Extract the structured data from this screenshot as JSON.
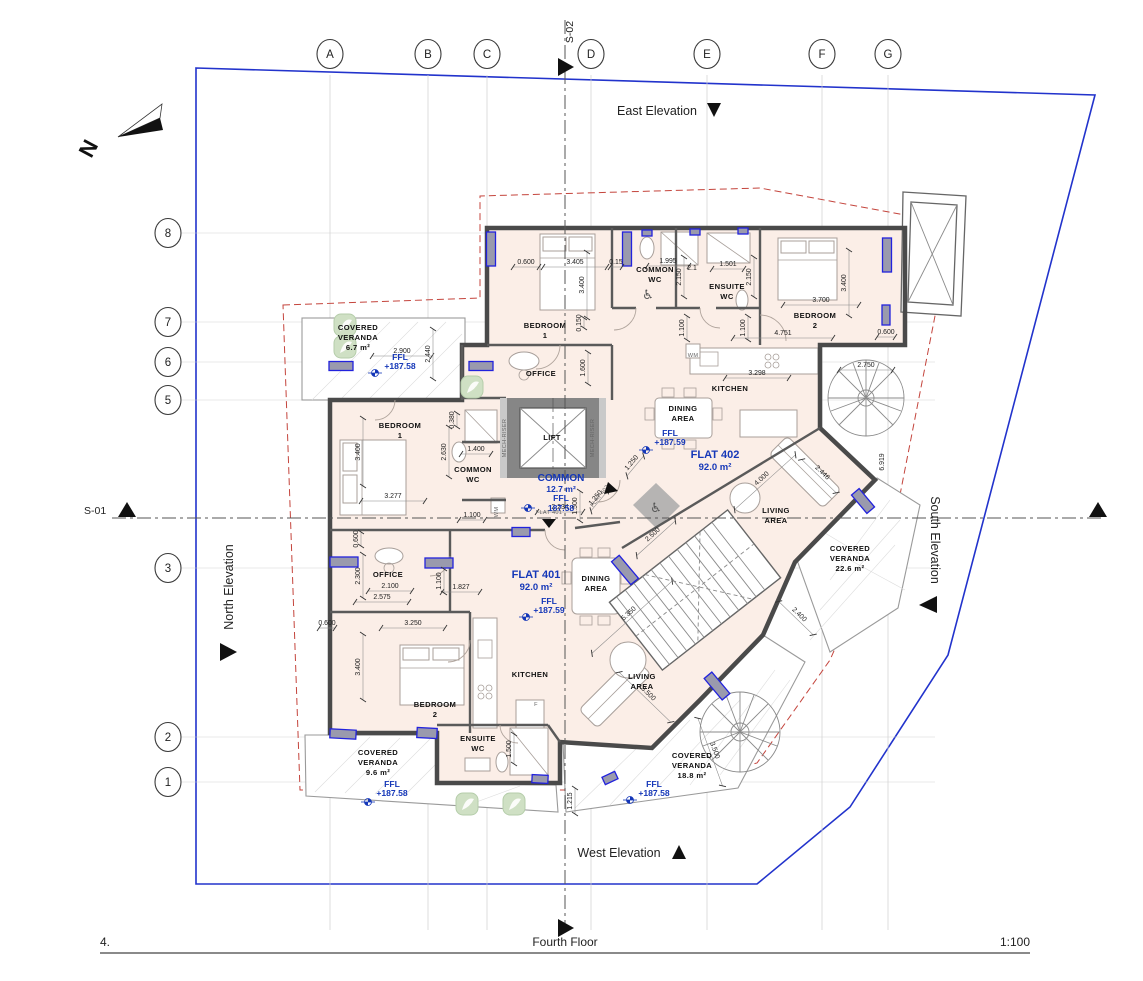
{
  "sheet": {
    "number": "4.",
    "title": "Fourth Floor",
    "scale": "1:100"
  },
  "north_arrow": {
    "label": "N"
  },
  "section_markers": {
    "s01": "S-01",
    "s02": "S-02"
  },
  "elevation_labels": {
    "east": "East Elevation",
    "west": "West Elevation",
    "north": "North Elevation",
    "south": "South Elevation"
  },
  "grid": {
    "columns": [
      {
        "label": "A",
        "x": 330
      },
      {
        "label": "B",
        "x": 428
      },
      {
        "label": "C",
        "x": 487
      },
      {
        "label": "D",
        "x": 591
      },
      {
        "label": "E",
        "x": 707
      },
      {
        "label": "F",
        "x": 822
      },
      {
        "label": "G",
        "x": 888
      }
    ],
    "rows": [
      {
        "label": "8",
        "y": 233
      },
      {
        "label": "7",
        "y": 322
      },
      {
        "label": "6",
        "y": 362
      },
      {
        "label": "5",
        "y": 400
      },
      {
        "label": "3",
        "y": 568
      },
      {
        "label": "2",
        "y": 737
      },
      {
        "label": "1",
        "y": 782
      }
    ]
  },
  "flats": [
    {
      "id": "FLAT 401",
      "area": "92.0 m²",
      "ffl": "+187.59"
    },
    {
      "id": "FLAT 402",
      "area": "92.0 m²",
      "ffl": "+187.59"
    }
  ],
  "common_area": {
    "name": "COMMON",
    "area": "12.7 m²",
    "ffl": "187.58"
  },
  "room_labels": [
    {
      "t": "BEDROOM",
      "x": 545,
      "y": 328
    },
    {
      "t": "1",
      "x": 545,
      "y": 338
    },
    {
      "t": "COMMON",
      "x": 655,
      "y": 272
    },
    {
      "t": "WC",
      "x": 655,
      "y": 282
    },
    {
      "t": "ENSUITE",
      "x": 727,
      "y": 289
    },
    {
      "t": "WC",
      "x": 727,
      "y": 299
    },
    {
      "t": "BEDROOM",
      "x": 815,
      "y": 318
    },
    {
      "t": "2",
      "x": 815,
      "y": 328
    },
    {
      "t": "OFFICE",
      "x": 541,
      "y": 376
    },
    {
      "t": "KITCHEN",
      "x": 730,
      "y": 391
    },
    {
      "t": "DINING",
      "x": 683,
      "y": 411
    },
    {
      "t": "AREA",
      "x": 683,
      "y": 421
    },
    {
      "t": "LIVING",
      "x": 776,
      "y": 513
    },
    {
      "t": "AREA",
      "x": 776,
      "y": 523
    },
    {
      "t": "BEDROOM",
      "x": 400,
      "y": 428
    },
    {
      "t": "1",
      "x": 400,
      "y": 438
    },
    {
      "t": "COMMON",
      "x": 473,
      "y": 472
    },
    {
      "t": "WC",
      "x": 473,
      "y": 482
    },
    {
      "t": "LIFT",
      "x": 552,
      "y": 440
    },
    {
      "t": "OFFICE",
      "x": 388,
      "y": 577
    },
    {
      "t": "DINING",
      "x": 596,
      "y": 581
    },
    {
      "t": "AREA",
      "x": 596,
      "y": 591
    },
    {
      "t": "KITCHEN",
      "x": 530,
      "y": 677
    },
    {
      "t": "LIVING",
      "x": 642,
      "y": 679
    },
    {
      "t": "AREA",
      "x": 642,
      "y": 689
    },
    {
      "t": "BEDROOM",
      "x": 435,
      "y": 707
    },
    {
      "t": "2",
      "x": 435,
      "y": 717
    },
    {
      "t": "ENSUITE",
      "x": 478,
      "y": 741
    },
    {
      "t": "WC",
      "x": 478,
      "y": 751
    }
  ],
  "veranda_labels": [
    {
      "t": "COVERED",
      "x": 358,
      "y": 330
    },
    {
      "t": "VERANDA",
      "x": 358,
      "y": 340
    },
    {
      "t": "6.7 m²",
      "x": 358,
      "y": 350
    },
    {
      "t": "COVERED",
      "x": 378,
      "y": 755
    },
    {
      "t": "VERANDA",
      "x": 378,
      "y": 765
    },
    {
      "t": "9.6 m²",
      "x": 378,
      "y": 775
    },
    {
      "t": "COVERED",
      "x": 692,
      "y": 758
    },
    {
      "t": "VERANDA",
      "x": 692,
      "y": 768
    },
    {
      "t": "18.8 m²",
      "x": 692,
      "y": 778
    },
    {
      "t": "COVERED",
      "x": 850,
      "y": 551
    },
    {
      "t": "VERANDA",
      "x": 850,
      "y": 561
    },
    {
      "t": "22.6 m²",
      "x": 850,
      "y": 571
    }
  ],
  "blue_labels": [
    {
      "t": "FFL",
      "x": 400,
      "y": 360
    },
    {
      "t": "+187.58",
      "x": 400,
      "y": 369
    },
    {
      "t": "COMMON",
      "x": 561,
      "y": 481,
      "s": 10
    },
    {
      "t": "12.7 m²",
      "x": 561,
      "y": 492
    },
    {
      "t": "FFL",
      "x": 561,
      "y": 501
    },
    {
      "t": "187.58",
      "x": 561,
      "y": 511
    },
    {
      "t": "FLAT 402",
      "x": 715,
      "y": 458,
      "s": 11
    },
    {
      "t": "92.0 m²",
      "x": 715,
      "y": 470,
      "s": 9.5
    },
    {
      "t": "FFL",
      "x": 670,
      "y": 436
    },
    {
      "t": "+187.59",
      "x": 670,
      "y": 445
    },
    {
      "t": "FLAT 401",
      "x": 536,
      "y": 578,
      "s": 11
    },
    {
      "t": "92.0 m²",
      "x": 536,
      "y": 590,
      "s": 9.5
    },
    {
      "t": "FFL",
      "x": 549,
      "y": 604
    },
    {
      "t": "+187.59",
      "x": 549,
      "y": 613
    },
    {
      "t": "FFL",
      "x": 392,
      "y": 787
    },
    {
      "t": "+187.58",
      "x": 392,
      "y": 796
    },
    {
      "t": "FFL",
      "x": 654,
      "y": 787
    },
    {
      "t": "+187.58",
      "x": 654,
      "y": 796
    }
  ],
  "dimensions": [
    {
      "t": "0.600",
      "x": 526,
      "y": 264,
      "l": 26
    },
    {
      "t": "3.405",
      "x": 575,
      "y": 264,
      "l": 64
    },
    {
      "t": "0.15",
      "x": 616,
      "y": 264,
      "l": 12
    },
    {
      "t": "1.995",
      "x": 668,
      "y": 263,
      "l": 42
    },
    {
      "t": "2.1",
      "x": 692,
      "y": 270
    },
    {
      "t": "1.501",
      "x": 728,
      "y": 266,
      "l": 32
    },
    {
      "t": "2.150",
      "x": 681,
      "y": 277,
      "r": -90,
      "l": 40
    },
    {
      "t": "2.150",
      "x": 751,
      "y": 277,
      "r": -90,
      "l": 40
    },
    {
      "t": "3.400",
      "x": 584,
      "y": 285,
      "r": -90,
      "l": 66
    },
    {
      "t": "0.150",
      "x": 581,
      "y": 323,
      "r": -90,
      "l": 10
    },
    {
      "t": "1.600",
      "x": 585,
      "y": 368,
      "r": -90,
      "l": 32
    },
    {
      "t": "1.100",
      "x": 684,
      "y": 328,
      "r": -90,
      "l": 24
    },
    {
      "t": "1.100",
      "x": 745,
      "y": 328,
      "r": -90,
      "l": 24
    },
    {
      "t": "3.700",
      "x": 821,
      "y": 302,
      "l": 76
    },
    {
      "t": "3.400",
      "x": 846,
      "y": 283,
      "r": -90,
      "l": 66
    },
    {
      "t": "4.751",
      "x": 783,
      "y": 335,
      "l": 100
    },
    {
      "t": "0.600",
      "x": 886,
      "y": 334,
      "l": 18
    },
    {
      "t": "2.750",
      "x": 866,
      "y": 367,
      "l": 54
    },
    {
      "t": "3.298",
      "x": 757,
      "y": 375,
      "l": 64
    },
    {
      "t": "2.900",
      "x": 402,
      "y": 353,
      "l": 60
    },
    {
      "t": "2.440",
      "x": 430,
      "y": 354,
      "r": -90,
      "l": 50
    },
    {
      "t": "3.400",
      "x": 360,
      "y": 452,
      "r": -90,
      "l": 68
    },
    {
      "t": "3.277",
      "x": 393,
      "y": 498,
      "l": 64
    },
    {
      "t": "1.400",
      "x": 476,
      "y": 451,
      "l": 30
    },
    {
      "t": "0.380",
      "x": 454,
      "y": 420,
      "r": -90,
      "l": 14
    },
    {
      "t": "2.630",
      "x": 446,
      "y": 452,
      "r": -90,
      "l": 50
    },
    {
      "t": "1.100",
      "x": 472,
      "y": 517,
      "l": 26
    },
    {
      "t": "2.234",
      "x": 560,
      "y": 509,
      "l": 46
    },
    {
      "t": "1.500",
      "x": 577,
      "y": 506,
      "r": -90,
      "l": 30
    },
    {
      "t": "1.250",
      "x": 633,
      "y": 464,
      "r": -50,
      "l": 26
    },
    {
      "t": "1.250",
      "x": 597,
      "y": 499,
      "r": -50,
      "l": 26
    },
    {
      "t": "2.300",
      "x": 360,
      "y": 576,
      "r": -90,
      "l": 44
    },
    {
      "t": "0.600",
      "x": 358,
      "y": 539,
      "r": -90,
      "l": 14
    },
    {
      "t": "2.100",
      "x": 390,
      "y": 588,
      "l": 44
    },
    {
      "t": "2.575",
      "x": 382,
      "y": 599,
      "l": 54
    },
    {
      "t": "1.827",
      "x": 461,
      "y": 589,
      "l": 38
    },
    {
      "t": "1.100",
      "x": 441,
      "y": 581,
      "r": -90,
      "l": 24
    },
    {
      "t": "0.600",
      "x": 327,
      "y": 625,
      "l": 16
    },
    {
      "t": "3.250",
      "x": 413,
      "y": 625,
      "l": 64
    },
    {
      "t": "3.400",
      "x": 360,
      "y": 667,
      "r": -90,
      "l": 66
    },
    {
      "t": "1.500",
      "x": 511,
      "y": 749,
      "r": -90,
      "l": 30
    },
    {
      "t": "1.215",
      "x": 572,
      "y": 801,
      "r": -90,
      "l": 26
    },
    {
      "t": "2.500",
      "x": 654,
      "y": 536,
      "r": -42,
      "l": 52
    },
    {
      "t": "5.350",
      "x": 630,
      "y": 615,
      "r": -42,
      "l": 108
    },
    {
      "t": "3.500",
      "x": 647,
      "y": 695,
      "r": 44,
      "l": 72
    },
    {
      "t": "3.500",
      "x": 713,
      "y": 751,
      "r": 70,
      "l": 72
    },
    {
      "t": "2.400",
      "x": 798,
      "y": 616,
      "r": 44,
      "l": 48
    },
    {
      "t": "4.000",
      "x": 763,
      "y": 480,
      "r": -42,
      "l": 82
    },
    {
      "t": "2.446",
      "x": 821,
      "y": 474,
      "r": 44,
      "l": 48
    },
    {
      "t": "6.919",
      "x": 884,
      "y": 462,
      "r": -90
    }
  ],
  "small_labels": [
    {
      "t": "WM",
      "x": 498,
      "y": 512,
      "r": -90
    },
    {
      "t": "WM",
      "x": 693,
      "y": 357
    },
    {
      "t": "F",
      "x": 536,
      "y": 706
    },
    {
      "t": "MECH-RISER",
      "x": 506,
      "y": 438,
      "r": -90
    },
    {
      "t": "MECH-RISER",
      "x": 594,
      "y": 438,
      "r": -90
    },
    {
      "t": "FLAT 401",
      "x": 549,
      "y": 514
    },
    {
      "t": "FLAT 402",
      "x": 601,
      "y": 497,
      "r": -52
    }
  ],
  "windows": [
    {
      "x": 341,
      "y": 366,
      "w": 24,
      "h": 9
    },
    {
      "x": 481,
      "y": 366,
      "w": 24,
      "h": 9
    },
    {
      "x": 491,
      "y": 249,
      "w": 9,
      "h": 34
    },
    {
      "x": 627,
      "y": 249,
      "w": 9,
      "h": 34
    },
    {
      "x": 887,
      "y": 255,
      "w": 9,
      "h": 34
    },
    {
      "x": 886,
      "y": 315,
      "w": 8,
      "h": 20
    },
    {
      "x": 647,
      "y": 233,
      "w": 10,
      "h": 6
    },
    {
      "x": 695,
      "y": 232,
      "w": 10,
      "h": 6
    },
    {
      "x": 743,
      "y": 231,
      "w": 10,
      "h": 6
    },
    {
      "x": 344,
      "y": 562,
      "w": 28,
      "h": 10
    },
    {
      "x": 439,
      "y": 563,
      "w": 28,
      "h": 10
    },
    {
      "x": 521,
      "y": 532,
      "w": 18,
      "h": 9
    },
    {
      "x": 343,
      "y": 734,
      "w": 26,
      "h": 9,
      "r": 3
    },
    {
      "x": 427,
      "y": 733,
      "w": 20,
      "h": 10,
      "r": 3
    },
    {
      "x": 540,
      "y": 779,
      "w": 16,
      "h": 8,
      "r": 3
    },
    {
      "x": 610,
      "y": 778,
      "w": 14,
      "h": 8,
      "r": -25
    },
    {
      "x": 625,
      "y": 570,
      "w": 30,
      "h": 10,
      "r": 50
    },
    {
      "x": 863,
      "y": 501,
      "w": 24,
      "h": 10,
      "r": 50
    },
    {
      "x": 717,
      "y": 686,
      "w": 28,
      "h": 10,
      "r": 50
    }
  ],
  "plants": [
    {
      "x": 345,
      "y": 325
    },
    {
      "x": 345,
      "y": 347
    },
    {
      "x": 472,
      "y": 387
    },
    {
      "x": 467,
      "y": 804
    },
    {
      "x": 514,
      "y": 804
    }
  ],
  "level_markers": [
    {
      "x": 375,
      "y": 373
    },
    {
      "x": 528,
      "y": 508
    },
    {
      "x": 646,
      "y": 450
    },
    {
      "x": 526,
      "y": 617
    },
    {
      "x": 368,
      "y": 802
    },
    {
      "x": 630,
      "y": 800
    }
  ],
  "colors": {
    "site_boundary": "#2233cc",
    "walls": "#4a4a4a",
    "floor": "#fbeee7",
    "window": "#2222dd",
    "setback_dashed": "#c4443c",
    "annotation_blue": "#1537b8"
  }
}
